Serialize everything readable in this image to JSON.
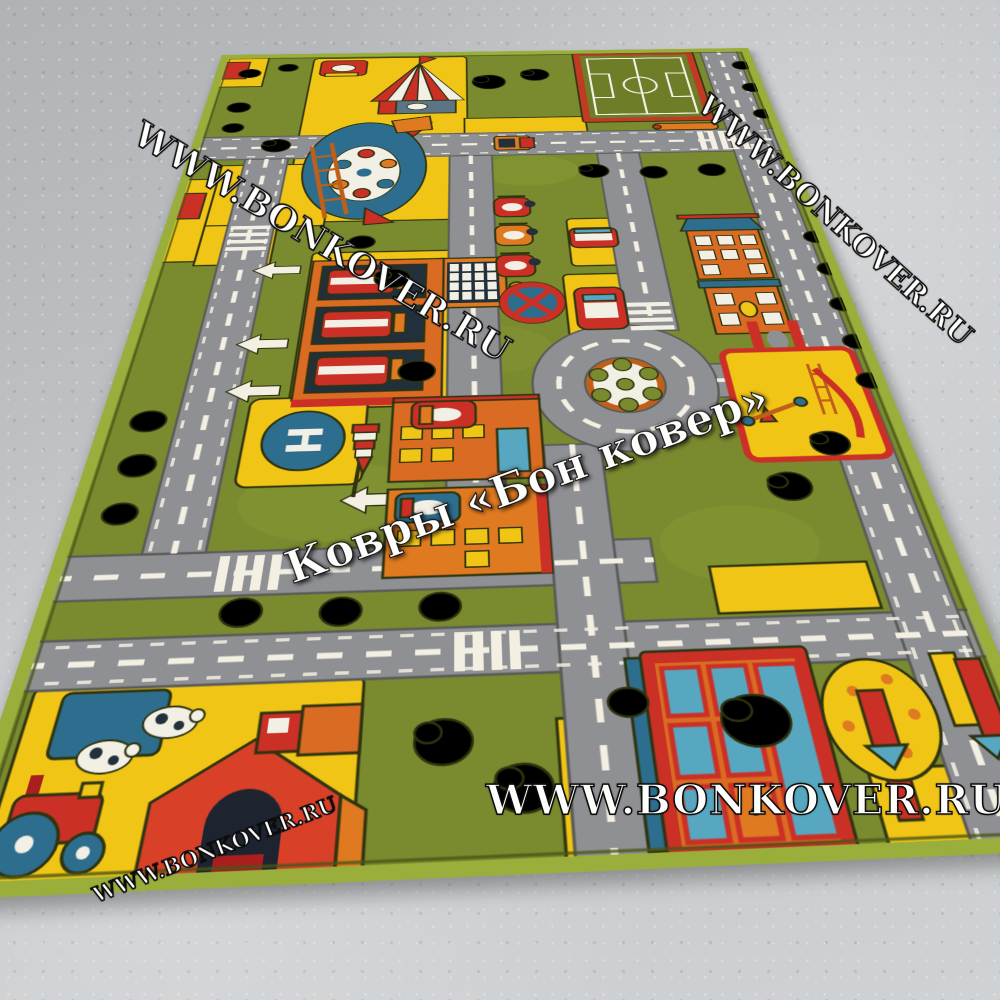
{
  "scene": {
    "description": "Photo of a children's city-roads play rug lying in perspective on a speckled gray concrete floor",
    "rug_motifs": [
      "soccer field",
      "circus tent",
      "ferris wheel",
      "fire station with trucks",
      "traffic riders",
      "no-stopping sign",
      "roundabout with wheel ornament",
      "helipad",
      "windsock",
      "apartment buildings",
      "playground with slide and seesaw",
      "farm with barn, cows and tractor",
      "large shop building",
      "spotted tree",
      "roads with white dashes",
      "zebra crossings",
      "trees"
    ]
  },
  "watermarks": {
    "top_left": "WWW.BONKOVER.RU",
    "top_right": "WWW.BONKOVER.RU",
    "center": "Ковры «Бон ковер»",
    "bottom": "WWW.BONKOVER.RU",
    "bottom_left": "WWW.BONKOVER.RU"
  },
  "rug": {
    "helipad_letter": "H"
  },
  "palette": {
    "grass": "#7a8a2e",
    "grass_light": "#8d9d38",
    "road": "#8f9094",
    "road_edge": "#5a5b58",
    "line_white": "#f3efe2",
    "yellow": "#f0c516",
    "red": "#cb3026",
    "dark_red": "#a81f1d",
    "orange": "#df7a20",
    "blue": "#2d6e8e",
    "teal": "#57a7c0",
    "navy": "#22303c",
    "dark": "#2e3310",
    "white": "#f2efe4",
    "binding": "#9aae3c",
    "floor": "#c3c6c9"
  }
}
